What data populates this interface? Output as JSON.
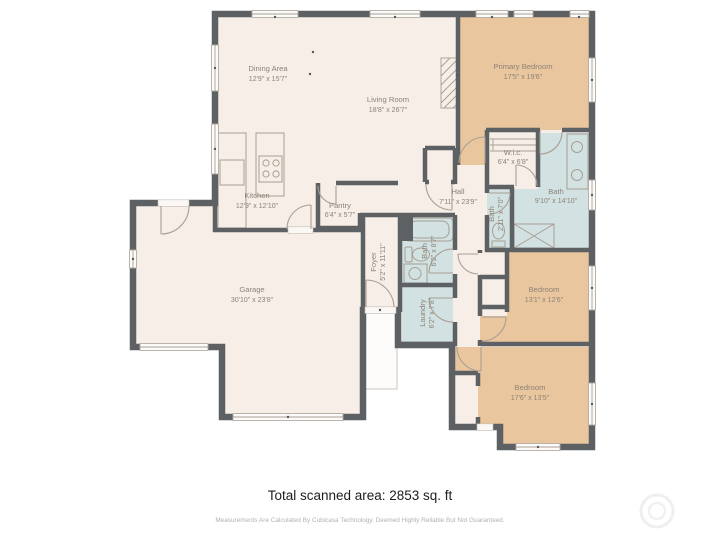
{
  "rooms": {
    "dining": {
      "name": "Dining Area",
      "dims": "12'9\" x 15'7\""
    },
    "living": {
      "name": "Living Room",
      "dims": "18'8\" x 26'7\""
    },
    "kitchen": {
      "name": "Kitchen",
      "dims": "12'9\" x 12'10\""
    },
    "pantry": {
      "name": "Pantry",
      "dims": "6'4\" x 5'7\""
    },
    "primary": {
      "name": "Primary Bedroom",
      "dims": "17'5\" x 19'6\""
    },
    "wic": {
      "name": "W.i.c.",
      "dims": "6'4\" x 6'8\""
    },
    "bath_main": {
      "name": "Bath",
      "dims": "9'10\" x 14'10\""
    },
    "bath_small": {
      "name": "Bath",
      "dims": "2'11\" x 7'0\""
    },
    "hall": {
      "name": "Hall",
      "dims": "7'11\" x 23'9\""
    },
    "foyer": {
      "name": "Foyer",
      "dims": "5'2\" x 11'11\""
    },
    "bath_hall": {
      "name": "Bath",
      "dims": "6'2\" x 8'7\""
    },
    "laundry": {
      "name": "Laundry",
      "dims": "6'2\" x 7'8\""
    },
    "garage": {
      "name": "Garage",
      "dims": "30'10\" x 23'8\""
    },
    "bedroom_mid": {
      "name": "Bedroom",
      "dims": "13'1\" x 12'6\""
    },
    "bedroom_btm": {
      "name": "Bedroom",
      "dims": "17'6\" x 13'5\""
    }
  },
  "footer": {
    "total": "Total scanned area: 2853 sq. ft",
    "disclaimer": "Measurements Are Calculated By Cubicasa Technology. Deemed Highly Reliable But Not Guaranteed."
  },
  "colors": {
    "wall": "#5e6164",
    "room_default": "#f6eee7",
    "bedroom": "#e9c69d",
    "bath": "#d2e1e1",
    "label": "#8d8478"
  }
}
